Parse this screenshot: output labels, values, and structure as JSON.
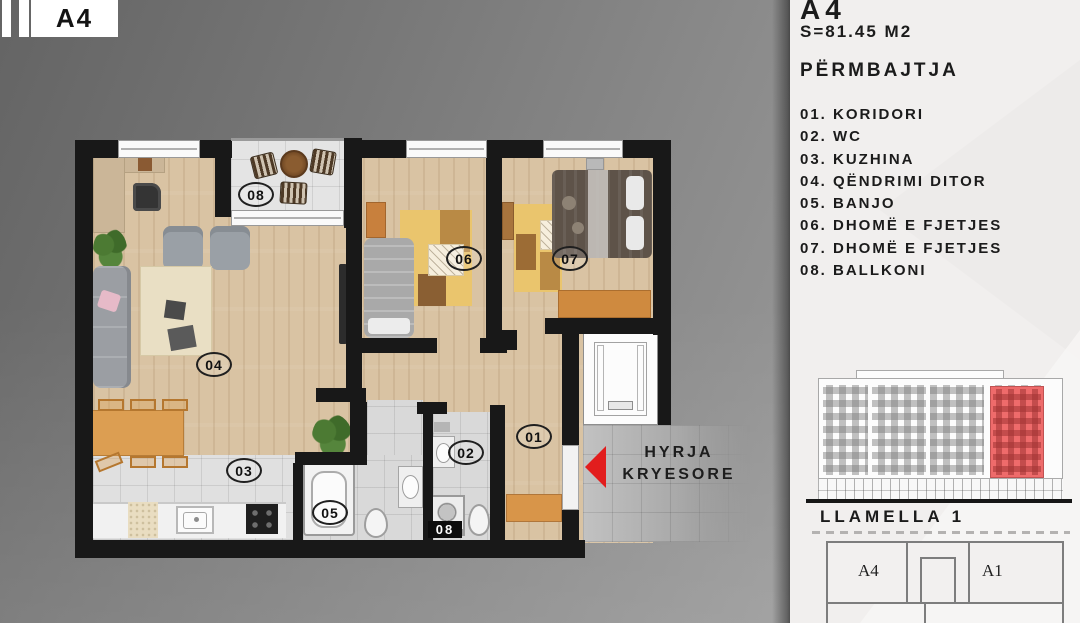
{
  "logo": {
    "unit": "A4"
  },
  "panel": {
    "unit_title": "A4",
    "area": "S=81.45 M2",
    "contents_heading": "PËRMBAJTJA",
    "rooms": [
      "01. KORIDORI",
      "02. WC",
      "03. KUZHINA",
      "04. QËNDRIMI DITOR",
      "05. BANJO",
      "06. DHOMË E FJETJES",
      "07. DHOMË E FJETJES",
      "08. BALLKONI"
    ],
    "building_label": "LLAMELLA 1",
    "site_diagram": {
      "unit_left": "A4",
      "unit_right": "A1"
    }
  },
  "plan": {
    "entrance_label": {
      "line1": "HYRJA",
      "line2": "KRYESORE"
    },
    "room_numbers": {
      "corridor": "01",
      "wc": "02",
      "kitchen": "03",
      "living": "04",
      "bath": "05",
      "bedroom_a": "06",
      "bedroom_b": "07",
      "balcony": "08",
      "utility_tag": "08"
    }
  },
  "colors": {
    "entrance_arrow": "#e21d1d",
    "elevation_highlight": "#ee6b6b",
    "wall": "#181818",
    "wood_floor": "#d9c3a3",
    "accent_orange": "#d89549",
    "rug_yellow": "#eac56d"
  }
}
